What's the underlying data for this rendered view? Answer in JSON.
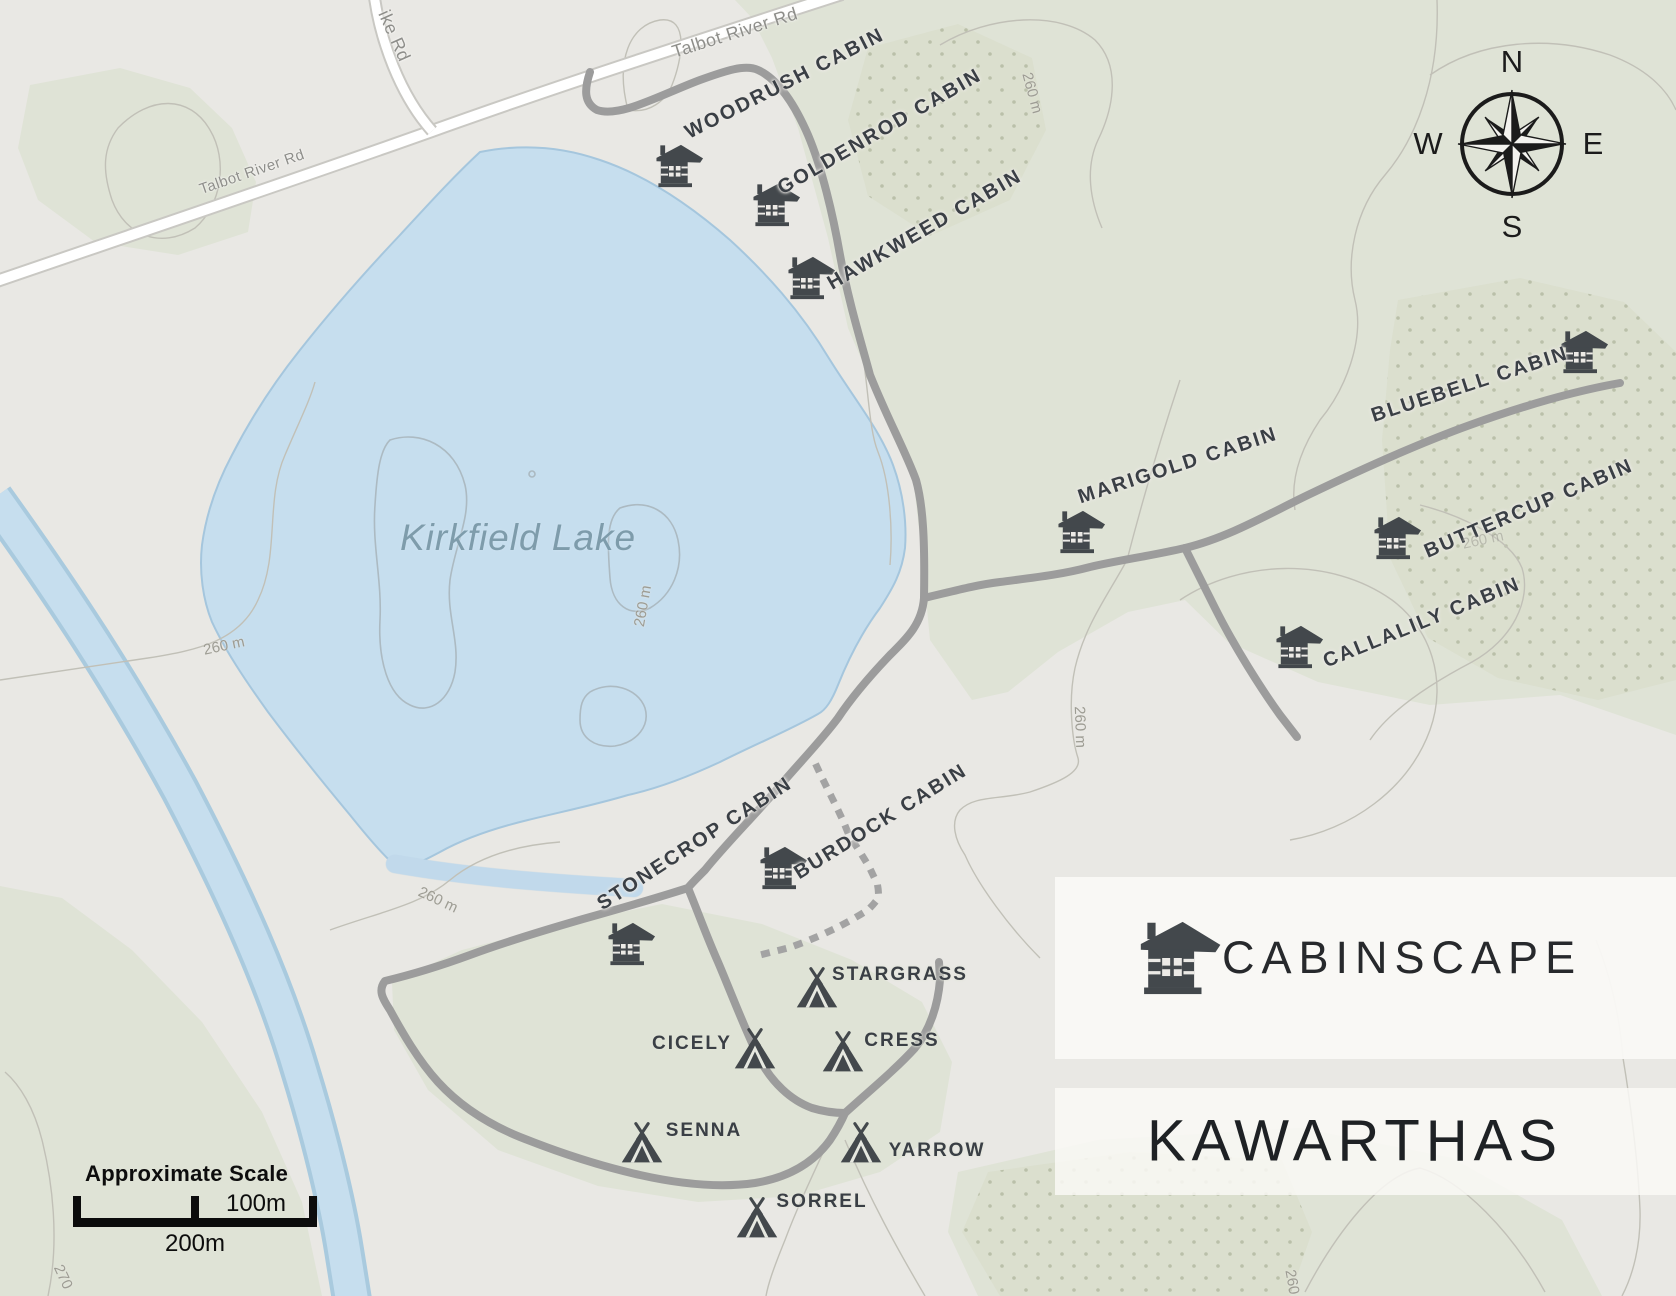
{
  "map": {
    "lake": {
      "name": "Kirkfield Lake"
    },
    "roads": {
      "talbot_river_rd_upper": "Talbot River Rd",
      "talbot_river_rd_lower": "Talbot River Rd",
      "ike_rd": "ike Rd"
    },
    "cabins": {
      "woodrush": "WOODRUSH CABIN",
      "goldenrod": "GOLDENROD CABIN",
      "hawkweed": "HAWKWEED CABIN",
      "marigold": "MARIGOLD CABIN",
      "bluebell": "BLUEBELL CABIN",
      "buttercup": "BUTTERCUP CABIN",
      "callalily": "CALLALILY CABIN",
      "stonecrop": "STONECROP CABIN",
      "burdock": "BURDOCK CABIN"
    },
    "tents": {
      "stargrass": "STARGRASS",
      "cicely": "CICELY",
      "cress": "CRESS",
      "senna": "SENNA",
      "yarrow": "YARROW",
      "sorrel": "SORREL"
    },
    "contour_labels": {
      "lake_west": "260 m",
      "lake_inner": "260 m",
      "north": "260 m",
      "east": "260 m",
      "buttercup": "260 m",
      "loop": "260 m",
      "bottom_left": "270",
      "bottom_right": "260"
    }
  },
  "compass": {
    "north": "N",
    "east": "E",
    "south": "S",
    "west": "W"
  },
  "scale_bar": {
    "title": "Approximate Scale",
    "half_label": "100m",
    "full_label": "200m"
  },
  "brand": {
    "name": "CABINSCAPE",
    "region": "KAWARTHAS"
  },
  "colors": {
    "water": "#c6deee",
    "vegetation": "#dfe3d6",
    "background": "#e9e8e4",
    "gray_road": "#9c9c9c",
    "white_road": "#ffffff",
    "icon": "#43484c",
    "label": "#3a3f45"
  }
}
